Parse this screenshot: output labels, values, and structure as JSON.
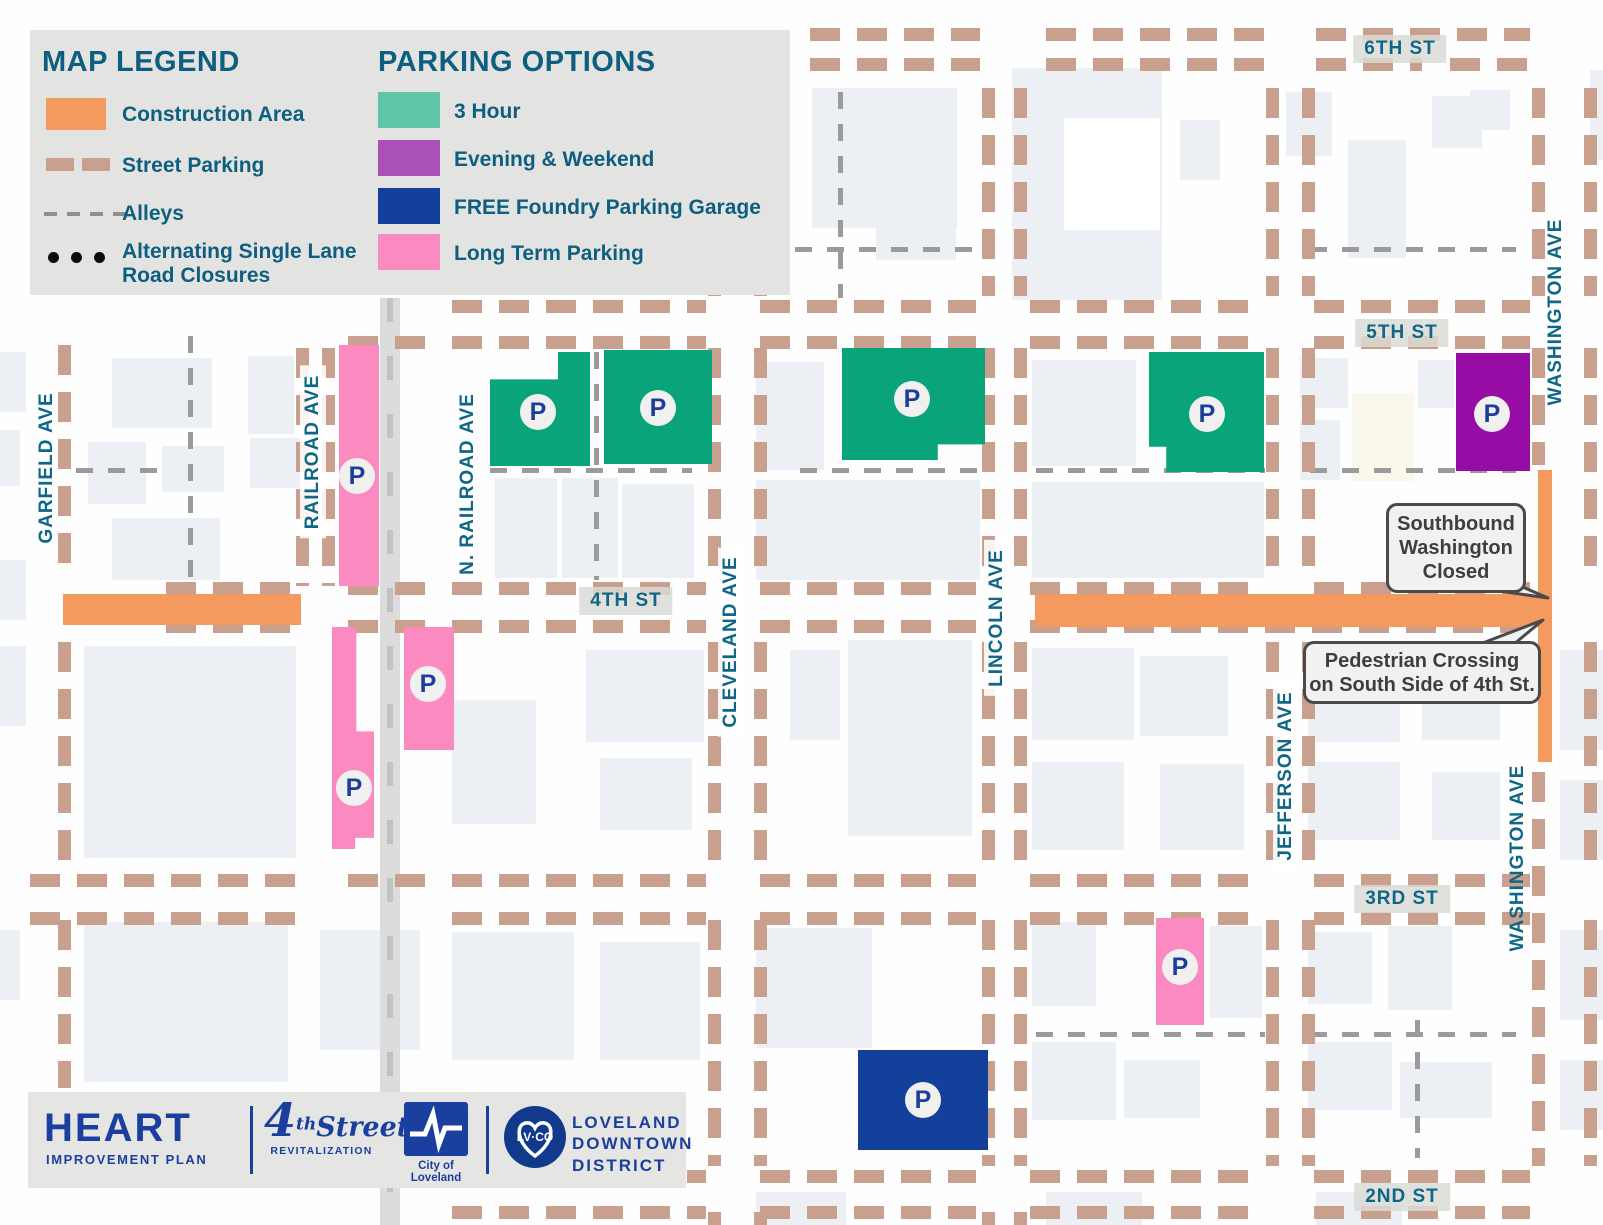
{
  "colors": {
    "construction": "#F49A5F",
    "tan_dash": "#C9A08D",
    "gray_dash": "#9B9B9B",
    "teal_text": "#0E6786",
    "legend_teal": "#0E5F7F",
    "parking_map": {
      "3hour": "#0AA47B",
      "evening": "#960CA4",
      "free": "#12409B",
      "longterm": "#FB8AC1"
    }
  },
  "legend": {
    "title": "MAP LEGEND",
    "items": [
      {
        "label": "Construction Area",
        "kind": "swatch",
        "color": "#F49A5F"
      },
      {
        "label": "Street Parking",
        "kind": "tan-dashes",
        "color": "#C9A08D"
      },
      {
        "label": "Alleys",
        "kind": "gray-dashes",
        "color": "#8F8F8F"
      },
      {
        "label": "Alternating Single Lane Road Closures",
        "line1": "Alternating Single Lane",
        "line2": "Road Closures",
        "kind": "dots",
        "color": "#0B0B0B"
      }
    ]
  },
  "parking_options": {
    "title": "PARKING OPTIONS",
    "items": [
      {
        "label": "3 Hour",
        "color": "#5FC7A7"
      },
      {
        "label": "Evening & Weekend",
        "color": "#AB51B6"
      },
      {
        "label": "FREE Foundry Parking Garage",
        "color": "#12409B"
      },
      {
        "label": "Long Term Parking",
        "color": "#FA8BC0"
      }
    ]
  },
  "callouts": [
    {
      "lines": [
        "Southbound",
        "Washington",
        "Closed"
      ]
    },
    {
      "lines": [
        "Pedestrian Crossing",
        "on South Side of 4th St."
      ]
    }
  ],
  "footer": {
    "heart": "HEART",
    "heart_sub": "IMPROVEMENT PLAN",
    "four_num": "4",
    "four_th": "th",
    "four_word": "Street",
    "four_sub": "REVITALIZATION",
    "city_caption": "City of Loveland",
    "lvco": "LV·CO",
    "district_line1": "LOVELAND",
    "district_line2": "DOWNTOWN",
    "district_line3": "DISTRICT"
  },
  "map": {
    "marker_letter": "P",
    "street_labels_h": [
      {
        "t": "6TH ST",
        "cx": 1400,
        "cy": 49
      },
      {
        "t": "5TH ST",
        "cx": 1402,
        "cy": 333
      },
      {
        "t": "4TH ST",
        "cx": 626,
        "cy": 601
      },
      {
        "t": "3RD ST",
        "cx": 1402,
        "cy": 899
      },
      {
        "t": "2ND ST",
        "cx": 1402,
        "cy": 1197
      }
    ],
    "street_labels_v": [
      {
        "t": "GARFIELD AVE",
        "cx": 47,
        "cy": 468,
        "b": false
      },
      {
        "t": "RAILROAD AVE",
        "cx": 313,
        "cy": 452,
        "b": true
      },
      {
        "t": "N. RAILROAD AVE",
        "cx": 468,
        "cy": 484,
        "b": false
      },
      {
        "t": "CLEVELAND AVE",
        "cx": 731,
        "cy": 642,
        "b": true
      },
      {
        "t": "LINCOLN AVE",
        "cx": 997,
        "cy": 618,
        "b": true
      },
      {
        "t": "JEFFERSON AVE",
        "cx": 1286,
        "cy": 776,
        "b": true
      },
      {
        "t": "WASHINGTON AVE",
        "cx": 1556,
        "cy": 312,
        "b": false
      },
      {
        "t": "WASHINGTON AVE",
        "cx": 1518,
        "cy": 858,
        "b": false
      }
    ],
    "parking_areas": [
      {
        "t": "3hour",
        "x": 490,
        "y": 352,
        "w": 100,
        "h": 114,
        "clip": "polygon(68% 0,100% 0,100% 100%,0 100%,0 24%,68% 24%)",
        "px": 538,
        "py": 412
      },
      {
        "t": "3hour",
        "x": 604,
        "y": 350,
        "w": 108,
        "h": 114,
        "clip": "",
        "px": 658,
        "py": 408
      },
      {
        "t": "3hour",
        "x": 842,
        "y": 348,
        "w": 143,
        "h": 112,
        "clip": "polygon(0 0,100% 0,100% 86%,67% 86%,67% 100%,0 100%)",
        "px": 912,
        "py": 399
      },
      {
        "t": "3hour",
        "x": 1149,
        "y": 352,
        "w": 115,
        "h": 120,
        "clip": "polygon(0 0,100% 0,100% 100%,15% 100%,15% 79%,0 79%)",
        "px": 1207,
        "py": 414
      },
      {
        "t": "evening",
        "x": 1456,
        "y": 353,
        "w": 74,
        "h": 118,
        "clip": "",
        "px": 1492,
        "py": 414
      },
      {
        "t": "longterm",
        "x": 339,
        "y": 345,
        "w": 40,
        "h": 241,
        "clip": "",
        "px": 357,
        "py": 476
      },
      {
        "t": "longterm",
        "x": 332,
        "y": 627,
        "w": 42,
        "h": 222,
        "clip": "polygon(0 0,58% 0,58% 47%,100% 47%,100% 95%,55% 95%,55% 100%,0 100%)",
        "px": 354,
        "py": 788
      },
      {
        "t": "longterm",
        "x": 404,
        "y": 627,
        "w": 50,
        "h": 123,
        "clip": "",
        "px": 428,
        "py": 684
      },
      {
        "t": "longterm",
        "x": 1156,
        "y": 918,
        "w": 48,
        "h": 107,
        "clip": "",
        "px": 1180,
        "py": 967
      },
      {
        "t": "free",
        "x": 858,
        "y": 1050,
        "w": 130,
        "h": 100,
        "clip": "",
        "px": 923,
        "py": 1100
      }
    ],
    "construction": [
      [
        63,
        594,
        238,
        31
      ],
      [
        1035,
        594,
        516,
        33
      ],
      [
        1538,
        470,
        14,
        292
      ]
    ],
    "tan_rows": [
      {
        "y": 28,
        "segs": [
          [
            810,
            980
          ],
          [
            1046,
            1264
          ],
          [
            1316,
            1530
          ]
        ]
      },
      {
        "y": 58,
        "segs": [
          [
            810,
            980
          ],
          [
            1046,
            1264
          ],
          [
            1316,
            1422
          ],
          [
            1450,
            1530
          ]
        ]
      },
      {
        "y": 300,
        "segs": [
          [
            452,
            706
          ],
          [
            760,
            976
          ],
          [
            1030,
            1262
          ],
          [
            1314,
            1530
          ]
        ]
      },
      {
        "y": 336,
        "segs": [
          [
            348,
            440
          ],
          [
            452,
            706
          ],
          [
            760,
            976
          ],
          [
            1030,
            1262
          ],
          [
            1314,
            1530
          ]
        ]
      },
      {
        "y": 582,
        "segs": [
          [
            166,
            298
          ],
          [
            348,
            440
          ],
          [
            452,
            706
          ],
          [
            760,
            976
          ],
          [
            1030,
            1262
          ],
          [
            1314,
            1530
          ]
        ]
      },
      {
        "y": 620,
        "segs": [
          [
            166,
            298
          ],
          [
            348,
            440
          ],
          [
            452,
            706
          ],
          [
            760,
            976
          ],
          [
            1030,
            1550
          ]
        ]
      },
      {
        "y": 874,
        "segs": [
          [
            30,
            298
          ],
          [
            348,
            440
          ],
          [
            452,
            706
          ],
          [
            760,
            976
          ],
          [
            1030,
            1262
          ],
          [
            1314,
            1530
          ]
        ]
      },
      {
        "y": 912,
        "segs": [
          [
            30,
            298
          ],
          [
            452,
            706
          ],
          [
            760,
            976
          ],
          [
            1030,
            1262
          ],
          [
            1314,
            1530
          ]
        ]
      },
      {
        "y": 1170,
        "segs": [
          [
            452,
            706
          ],
          [
            760,
            976
          ],
          [
            1030,
            1262
          ],
          [
            1314,
            1530
          ]
        ]
      },
      {
        "y": 1206,
        "segs": [
          [
            452,
            706
          ],
          [
            760,
            976
          ],
          [
            1030,
            1262
          ],
          [
            1314,
            1530
          ]
        ]
      }
    ],
    "tan_cols": [
      {
        "x": 58,
        "segs": [
          [
            345,
            580
          ],
          [
            642,
            870
          ],
          [
            920,
            1088
          ]
        ]
      },
      {
        "x": 296,
        "segs": [
          [
            348,
            586
          ]
        ]
      },
      {
        "x": 322,
        "segs": [
          [
            348,
            586
          ]
        ]
      },
      {
        "x": 708,
        "segs": [
          [
            88,
            296
          ],
          [
            348,
            578
          ],
          [
            642,
            870
          ],
          [
            920,
            1166
          ],
          [
            1212,
            1225
          ]
        ]
      },
      {
        "x": 754,
        "segs": [
          [
            88,
            296
          ],
          [
            348,
            578
          ],
          [
            642,
            870
          ],
          [
            920,
            1166
          ],
          [
            1212,
            1225
          ]
        ]
      },
      {
        "x": 982,
        "segs": [
          [
            88,
            296
          ],
          [
            348,
            578
          ],
          [
            642,
            870
          ],
          [
            920,
            1166
          ],
          [
            1212,
            1225
          ]
        ]
      },
      {
        "x": 1014,
        "segs": [
          [
            88,
            296
          ],
          [
            348,
            578
          ],
          [
            642,
            870
          ],
          [
            920,
            1166
          ],
          [
            1212,
            1225
          ]
        ]
      },
      {
        "x": 1266,
        "segs": [
          [
            88,
            296
          ],
          [
            348,
            578
          ],
          [
            642,
            870
          ],
          [
            920,
            1166
          ]
        ]
      },
      {
        "x": 1302,
        "segs": [
          [
            88,
            296
          ],
          [
            348,
            578
          ],
          [
            642,
            870
          ],
          [
            920,
            1166
          ]
        ]
      },
      {
        "x": 1532,
        "segs": [
          [
            88,
            296
          ],
          [
            348,
            465
          ],
          [
            772,
            1166
          ]
        ]
      },
      {
        "x": 1584,
        "segs": [
          [
            88,
            296
          ],
          [
            348,
            578
          ],
          [
            642,
            870
          ],
          [
            920,
            1166
          ]
        ]
      }
    ],
    "alley_rows": [
      {
        "y": 468,
        "segs": [
          [
            76,
            166
          ],
          [
            490,
            692
          ],
          [
            800,
            985
          ],
          [
            1036,
            1265
          ],
          [
            1310,
            1516
          ]
        ]
      },
      {
        "y": 247,
        "segs": [
          [
            795,
            978
          ],
          [
            1310,
            1516
          ]
        ]
      },
      {
        "y": 1032,
        "segs": [
          [
            1036,
            1265
          ],
          [
            1310,
            1516
          ]
        ]
      }
    ],
    "alley_cols": [
      {
        "x": 188,
        "segs": [
          [
            336,
            580
          ]
        ]
      },
      {
        "x": 594,
        "segs": [
          [
            352,
            580
          ]
        ]
      },
      {
        "x": 838,
        "segs": [
          [
            92,
            298
          ]
        ]
      },
      {
        "x": 1415,
        "segs": [
          [
            1020,
            1158
          ]
        ]
      }
    ],
    "railroad": {
      "x": 380,
      "y": 298,
      "w": 20,
      "h": 927
    },
    "buildings": [
      [
        812,
        88,
        145,
        140
      ],
      [
        876,
        160,
        80,
        100
      ],
      [
        1012,
        68,
        150,
        232
      ],
      [
        1064,
        118,
        96,
        112,
        "#FFFFFF"
      ],
      [
        1286,
        92,
        46,
        64
      ],
      [
        1348,
        140,
        58,
        118
      ],
      [
        1432,
        96,
        50,
        52
      ],
      [
        1180,
        120,
        40,
        60
      ],
      [
        1470,
        90,
        40,
        40
      ],
      [
        1590,
        70,
        13,
        90
      ],
      [
        112,
        358,
        100,
        70
      ],
      [
        88,
        442,
        58,
        62
      ],
      [
        162,
        446,
        62,
        46
      ],
      [
        112,
        518,
        108,
        62
      ],
      [
        248,
        356,
        46,
        78
      ],
      [
        250,
        438,
        58,
        50
      ],
      [
        495,
        478,
        62,
        100
      ],
      [
        562,
        478,
        56,
        100
      ],
      [
        622,
        484,
        72,
        94
      ],
      [
        756,
        362,
        68,
        108
      ],
      [
        756,
        480,
        224,
        100
      ],
      [
        1032,
        360,
        104,
        106
      ],
      [
        1032,
        482,
        232,
        96
      ],
      [
        1300,
        358,
        48,
        50
      ],
      [
        1352,
        393,
        62,
        88,
        "#FAF7EC"
      ],
      [
        1418,
        360,
        36,
        48
      ],
      [
        1300,
        420,
        40,
        60
      ],
      [
        84,
        646,
        212,
        212
      ],
      [
        452,
        700,
        84,
        124
      ],
      [
        586,
        650,
        118,
        92
      ],
      [
        600,
        758,
        92,
        72
      ],
      [
        790,
        650,
        50,
        90
      ],
      [
        848,
        640,
        124,
        196
      ],
      [
        1032,
        648,
        102,
        92
      ],
      [
        1140,
        656,
        88,
        80
      ],
      [
        1032,
        762,
        92,
        88
      ],
      [
        1160,
        764,
        84,
        86
      ],
      [
        1308,
        650,
        92,
        92
      ],
      [
        1422,
        652,
        78,
        88
      ],
      [
        1308,
        762,
        92,
        78
      ],
      [
        1432,
        772,
        68,
        68
      ],
      [
        1560,
        650,
        43,
        100
      ],
      [
        1560,
        780,
        43,
        80
      ],
      [
        84,
        922,
        204,
        160
      ],
      [
        320,
        930,
        100,
        120
      ],
      [
        452,
        932,
        122,
        128
      ],
      [
        600,
        942,
        100,
        118
      ],
      [
        756,
        928,
        116,
        120
      ],
      [
        1032,
        922,
        64,
        84
      ],
      [
        1210,
        926,
        52,
        92
      ],
      [
        1032,
        1042,
        84,
        78
      ],
      [
        1124,
        1060,
        76,
        58
      ],
      [
        1308,
        932,
        64,
        72
      ],
      [
        1388,
        926,
        64,
        84
      ],
      [
        1308,
        1042,
        84,
        68
      ],
      [
        1400,
        1062,
        92,
        56
      ],
      [
        1560,
        930,
        43,
        90
      ],
      [
        1560,
        1060,
        43,
        70
      ],
      [
        756,
        1192,
        90,
        33
      ],
      [
        1046,
        1192,
        96,
        33
      ],
      [
        1316,
        1192,
        86,
        33
      ],
      [
        0,
        352,
        26,
        60
      ],
      [
        0,
        430,
        20,
        56
      ],
      [
        0,
        560,
        26,
        60
      ],
      [
        0,
        646,
        26,
        80
      ],
      [
        0,
        930,
        20,
        70
      ]
    ]
  }
}
